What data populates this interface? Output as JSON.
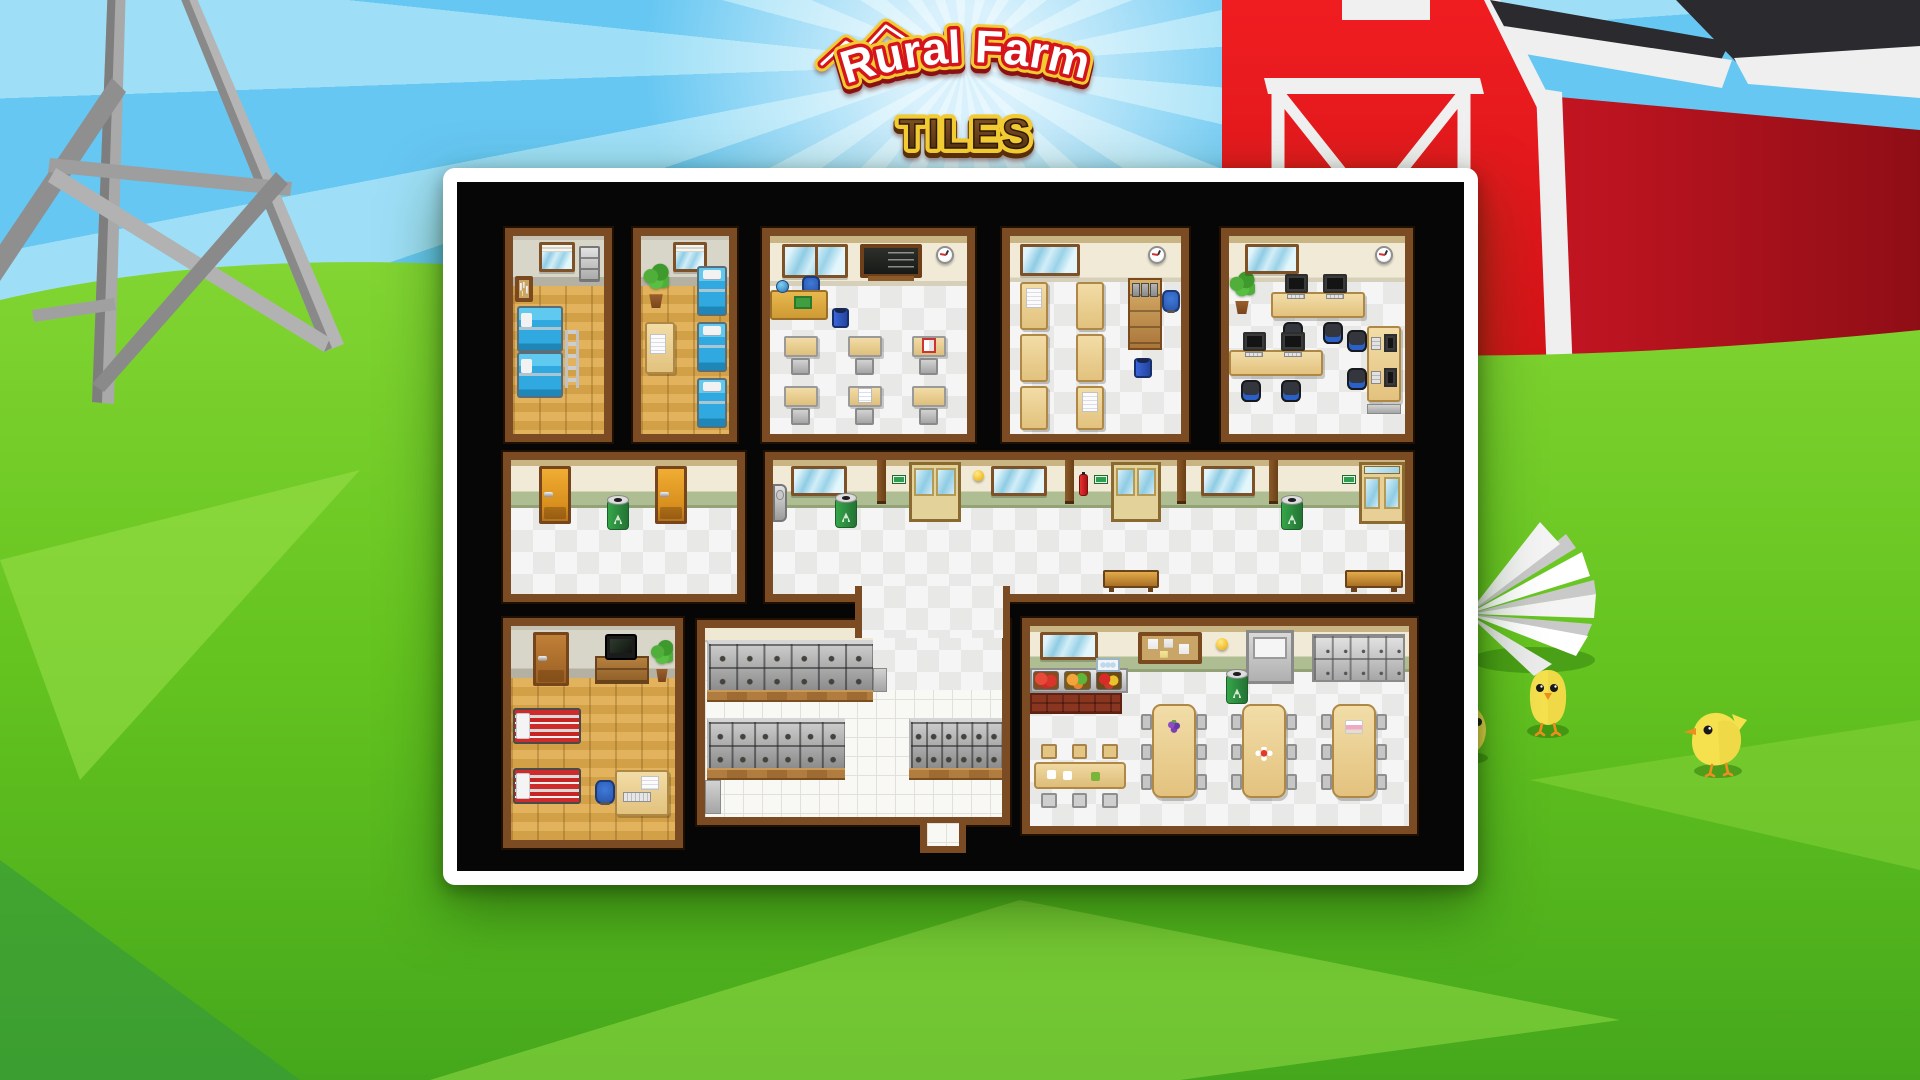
{
  "logo": {
    "line1": "Rural Farm",
    "line2": "TILES"
  },
  "scene": {
    "description": "tileset preview of a school/farmhouse interior map on a cartoon farm background",
    "decorations": [
      "water-tower",
      "red-barn",
      "sunburst-sky",
      "grass-hill",
      "white-pinwheel",
      "chicks"
    ],
    "chick_count": 3
  },
  "colors": {
    "sky_light": "#9edff7",
    "sky_ray": "#66c7f2",
    "grass": "#64c31f",
    "grass_light": "#9ae04a",
    "grass_dark": "#3fa31a",
    "barn_red": "#e81a1e",
    "barn_side": "#b01320",
    "roof_dark": "#2b2b2f",
    "trim_white": "#f0f0f0",
    "panel_bg": "#060606",
    "panel_border": "#ffffff",
    "room_frame": "#7b4b23",
    "wall_cream": "#f1ead6",
    "wainscot_green": "#aebd92",
    "wood_floor": "#d9a94e",
    "logo_red": "#d6141c",
    "logo_gold": "#f2ca32",
    "logo_brown": "#5b3317"
  },
  "panel": {
    "x": 443,
    "y": 168,
    "w": 1035,
    "h": 717,
    "border": 14
  },
  "extras": {
    "connector": {
      "x": 398,
      "y": 404,
      "w": 155,
      "h": 52
    },
    "stub": {
      "x": 463,
      "y": 641,
      "w": 46,
      "h": 30
    }
  },
  "rooms": [
    {
      "id": "dorm-a",
      "x": 48,
      "y": 46,
      "w": 107,
      "h": 214,
      "wall": "gray",
      "wallH": 50,
      "floor": "wood",
      "objects": [
        {
          "t": "window",
          "x": 26,
          "y": 6,
          "w": 36,
          "h": 30,
          "v": "blinds"
        },
        {
          "t": "cab",
          "x": 66,
          "y": 10,
          "w": 21,
          "h": 36
        },
        {
          "t": "board",
          "x": 2,
          "y": 40,
          "w": 18,
          "h": 26
        },
        {
          "t": "bunk",
          "x": 4,
          "y": 70,
          "w": 46,
          "h": 46
        },
        {
          "t": "bunk",
          "x": 4,
          "y": 116,
          "w": 46,
          "h": 46
        },
        {
          "t": "ladder",
          "x": 52,
          "y": 94,
          "w": 14,
          "h": 58
        }
      ]
    },
    {
      "id": "dorm-b",
      "x": 176,
      "y": 46,
      "w": 104,
      "h": 214,
      "wall": "gray",
      "wallH": 50,
      "floor": "wood",
      "objects": [
        {
          "t": "plant",
          "x": 2,
          "y": 26,
          "w": 26,
          "h": 46
        },
        {
          "t": "window",
          "x": 32,
          "y": 6,
          "w": 34,
          "h": 30,
          "v": "blinds"
        },
        {
          "t": "bunk",
          "x": 56,
          "y": 30,
          "w": 30,
          "h": 50,
          "v": "vert"
        },
        {
          "t": "bunk",
          "x": 56,
          "y": 86,
          "w": 30,
          "h": 50,
          "v": "vert"
        },
        {
          "t": "bunk",
          "x": 56,
          "y": 142,
          "w": 30,
          "h": 50,
          "v": "vert"
        },
        {
          "t": "deskV",
          "x": 4,
          "y": 86,
          "w": 30,
          "h": 52
        },
        {
          "t": "papers",
          "x": 9,
          "y": 98,
          "w": 16,
          "h": 20
        }
      ]
    },
    {
      "id": "classroom",
      "x": 305,
      "y": 46,
      "w": 213,
      "h": 214,
      "wall": "cream",
      "wallH": 50,
      "floor": "check",
      "objects": [
        {
          "t": "window",
          "x": 12,
          "y": 8,
          "w": 66,
          "h": 34,
          "v": "two"
        },
        {
          "t": "chalk",
          "x": 90,
          "y": 8,
          "w": 62,
          "h": 34
        },
        {
          "t": "clock",
          "x": 166,
          "y": 10,
          "w": 18,
          "h": 18
        },
        {
          "t": "ochair",
          "x": 32,
          "y": 40,
          "w": 18,
          "h": 18
        },
        {
          "t": "tdesk",
          "x": 0,
          "y": 54,
          "w": 58,
          "h": 30
        },
        {
          "t": "trash",
          "x": 62,
          "y": 72,
          "w": 17,
          "h": 20
        },
        {
          "t": "sdesk",
          "x": 14,
          "y": 100,
          "w": 34,
          "h": 40
        },
        {
          "t": "sdesk",
          "x": 78,
          "y": 100,
          "w": 34,
          "h": 40
        },
        {
          "t": "sdesk",
          "x": 142,
          "y": 100,
          "w": 34,
          "h": 40,
          "v": "book"
        },
        {
          "t": "sdesk",
          "x": 14,
          "y": 150,
          "w": 34,
          "h": 40
        },
        {
          "t": "sdesk",
          "x": 78,
          "y": 150,
          "w": 34,
          "h": 40,
          "v": "papers"
        },
        {
          "t": "sdesk",
          "x": 142,
          "y": 150,
          "w": 34,
          "h": 40
        }
      ]
    },
    {
      "id": "office",
      "x": 545,
      "y": 46,
      "w": 187,
      "h": 214,
      "wall": "cream",
      "wallH": 46,
      "floor": "check",
      "objects": [
        {
          "t": "window",
          "x": 10,
          "y": 8,
          "w": 60,
          "h": 32
        },
        {
          "t": "clock",
          "x": 138,
          "y": 10,
          "w": 18,
          "h": 18
        },
        {
          "t": "deskV",
          "x": 10,
          "y": 46,
          "w": 28,
          "h": 48
        },
        {
          "t": "papers",
          "x": 16,
          "y": 52,
          "w": 16,
          "h": 20
        },
        {
          "t": "deskV",
          "x": 66,
          "y": 46,
          "w": 28,
          "h": 48
        },
        {
          "t": "deskV",
          "x": 10,
          "y": 98,
          "w": 28,
          "h": 48
        },
        {
          "t": "deskV",
          "x": 66,
          "y": 98,
          "w": 28,
          "h": 48
        },
        {
          "t": "deskV",
          "x": 10,
          "y": 150,
          "w": 28,
          "h": 44
        },
        {
          "t": "deskV",
          "x": 66,
          "y": 150,
          "w": 28,
          "h": 44
        },
        {
          "t": "papers",
          "x": 72,
          "y": 156,
          "w": 16,
          "h": 20
        },
        {
          "t": "cabinet2",
          "x": 118,
          "y": 42,
          "w": 34,
          "h": 72
        },
        {
          "t": "ochair",
          "x": 152,
          "y": 54,
          "w": 18,
          "h": 22
        },
        {
          "t": "trash",
          "x": 124,
          "y": 122,
          "w": 18,
          "h": 20
        }
      ]
    },
    {
      "id": "computer-lab",
      "x": 764,
      "y": 46,
      "w": 192,
      "h": 214,
      "wall": "cream",
      "wallH": 46,
      "floor": "check",
      "objects": [
        {
          "t": "plant",
          "x": 0,
          "y": 34,
          "w": 26,
          "h": 44
        },
        {
          "t": "window",
          "x": 16,
          "y": 8,
          "w": 54,
          "h": 30
        },
        {
          "t": "clock",
          "x": 146,
          "y": 10,
          "w": 18,
          "h": 18
        },
        {
          "t": "pcdesk",
          "x": 42,
          "y": 56,
          "w": 94,
          "h": 26
        },
        {
          "t": "bchair",
          "x": 54,
          "y": 86,
          "w": 20,
          "h": 22
        },
        {
          "t": "bchair",
          "x": 94,
          "y": 86,
          "w": 20,
          "h": 22
        },
        {
          "t": "pcdesk",
          "x": 0,
          "y": 114,
          "w": 94,
          "h": 26
        },
        {
          "t": "bchair",
          "x": 12,
          "y": 144,
          "w": 20,
          "h": 22
        },
        {
          "t": "bchair",
          "x": 52,
          "y": 144,
          "w": 20,
          "h": 22
        },
        {
          "t": "pcdeskV",
          "x": 138,
          "y": 90,
          "w": 34,
          "h": 76
        },
        {
          "t": "bchair",
          "x": 118,
          "y": 94,
          "w": 20,
          "h": 22
        },
        {
          "t": "bchair",
          "x": 118,
          "y": 132,
          "w": 20,
          "h": 22
        },
        {
          "t": "mat",
          "x": 138,
          "y": 168,
          "w": 34,
          "h": 10
        }
      ]
    },
    {
      "id": "hall-west",
      "x": 46,
      "y": 270,
      "w": 242,
      "h": 150,
      "wall": "hall",
      "wallH": 48,
      "floor": "check",
      "objects": [
        {
          "t": "door",
          "x": 28,
          "y": 6,
          "w": 32,
          "h": 58
        },
        {
          "t": "door",
          "x": 144,
          "y": 6,
          "w": 32,
          "h": 58
        },
        {
          "t": "recycle",
          "x": 96,
          "y": 40,
          "w": 22,
          "h": 30
        }
      ]
    },
    {
      "id": "hall-main",
      "x": 308,
      "y": 270,
      "w": 648,
      "h": 150,
      "wall": "hall",
      "wallH": 48,
      "floor": "check",
      "objects": [
        {
          "t": "fountain",
          "x": 0,
          "y": 24,
          "w": 14,
          "h": 38
        },
        {
          "t": "window",
          "x": 18,
          "y": 6,
          "w": 56,
          "h": 30
        },
        {
          "t": "recycle",
          "x": 62,
          "y": 38,
          "w": 22,
          "h": 30
        },
        {
          "t": "pilaster",
          "x": 104,
          "y": 0,
          "w": 9,
          "h": 44
        },
        {
          "t": "sign",
          "x": 120,
          "y": 16,
          "w": 12,
          "h": 7
        },
        {
          "t": "ddoor",
          "x": 136,
          "y": 2,
          "w": 52,
          "h": 60
        },
        {
          "t": "ball",
          "x": 200,
          "y": 10,
          "w": 11,
          "h": 11
        },
        {
          "t": "window",
          "x": 218,
          "y": 6,
          "w": 56,
          "h": 30
        },
        {
          "t": "pilaster",
          "x": 292,
          "y": 0,
          "w": 9,
          "h": 44
        },
        {
          "t": "ext",
          "x": 306,
          "y": 14,
          "w": 9,
          "h": 22
        },
        {
          "t": "sign",
          "x": 322,
          "y": 16,
          "w": 12,
          "h": 7
        },
        {
          "t": "ddoor",
          "x": 338,
          "y": 2,
          "w": 50,
          "h": 60
        },
        {
          "t": "pilaster",
          "x": 404,
          "y": 0,
          "w": 9,
          "h": 44
        },
        {
          "t": "window",
          "x": 428,
          "y": 6,
          "w": 54,
          "h": 30
        },
        {
          "t": "pilaster",
          "x": 496,
          "y": 0,
          "w": 9,
          "h": 44
        },
        {
          "t": "recycle",
          "x": 508,
          "y": 40,
          "w": 22,
          "h": 30
        },
        {
          "t": "sign",
          "x": 570,
          "y": 16,
          "w": 12,
          "h": 7
        },
        {
          "t": "gdoor",
          "x": 586,
          "y": 2,
          "w": 46,
          "h": 62
        },
        {
          "t": "bench",
          "x": 330,
          "y": 110,
          "w": 56,
          "h": 18
        },
        {
          "t": "bench",
          "x": 572,
          "y": 110,
          "w": 58,
          "h": 18
        }
      ]
    },
    {
      "id": "dorm-c",
      "x": 46,
      "y": 436,
      "w": 180,
      "h": 230,
      "wall": "gray",
      "wallH": 52,
      "floor": "wood",
      "objects": [
        {
          "t": "door",
          "x": 22,
          "y": 6,
          "w": 36,
          "h": 54,
          "v": "brown"
        },
        {
          "t": "dresser",
          "x": 84,
          "y": 30,
          "w": 54,
          "h": 28
        },
        {
          "t": "tv",
          "x": 94,
          "y": 8,
          "w": 32,
          "h": 26
        },
        {
          "t": "plant",
          "x": 140,
          "y": 12,
          "w": 22,
          "h": 44
        },
        {
          "t": "redbed",
          "x": 2,
          "y": 82,
          "w": 68,
          "h": 36
        },
        {
          "t": "redbed",
          "x": 2,
          "y": 142,
          "w": 68,
          "h": 36
        },
        {
          "t": "deskV",
          "x": 104,
          "y": 144,
          "w": 54,
          "h": 46
        },
        {
          "t": "papers",
          "x": 130,
          "y": 150,
          "w": 18,
          "h": 14
        },
        {
          "t": "kb",
          "x": 112,
          "y": 166,
          "w": 28,
          "h": 10
        },
        {
          "t": "ochair",
          "x": 84,
          "y": 154,
          "w": 20,
          "h": 24
        }
      ]
    },
    {
      "id": "shoe-lockers",
      "x": 240,
      "y": 438,
      "w": 313,
      "h": 205,
      "wall": "creamthin",
      "wallH": 14,
      "floor": "tile",
      "objects": [
        {
          "t": "checkpatch",
          "x": 168,
          "y": 0,
          "w": 129,
          "h": 62
        },
        {
          "t": "cubby",
          "x": 2,
          "y": 12,
          "w": 166,
          "h": 50
        },
        {
          "t": "woodstrip",
          "x": 2,
          "y": 62,
          "w": 166,
          "h": 12
        },
        {
          "t": "step",
          "x": 168,
          "y": 40,
          "w": 14,
          "h": 24
        },
        {
          "t": "cubby",
          "x": 2,
          "y": 90,
          "w": 138,
          "h": 50
        },
        {
          "t": "woodstrip",
          "x": 2,
          "y": 140,
          "w": 138,
          "h": 12
        },
        {
          "t": "cubby",
          "x": 204,
          "y": 90,
          "w": 93,
          "h": 50
        },
        {
          "t": "woodstrip",
          "x": 204,
          "y": 140,
          "w": 93,
          "h": 12
        },
        {
          "t": "step",
          "x": 0,
          "y": 152,
          "w": 16,
          "h": 34
        }
      ]
    },
    {
      "id": "cafeteria",
      "x": 565,
      "y": 436,
      "w": 395,
      "h": 216,
      "wall": "hall",
      "wallH": 46,
      "floor": "check",
      "objects": [
        {
          "t": "window",
          "x": 10,
          "y": 6,
          "w": 58,
          "h": 28
        },
        {
          "t": "board",
          "x": 108,
          "y": 6,
          "w": 64,
          "h": 32,
          "v": "cork"
        },
        {
          "t": "ball",
          "x": 186,
          "y": 12,
          "w": 12,
          "h": 12
        },
        {
          "t": "mdoor",
          "x": 216,
          "y": 4,
          "w": 48,
          "h": 54
        },
        {
          "t": "lockers",
          "x": 282,
          "y": 8,
          "w": 93,
          "h": 48
        },
        {
          "t": "recycle",
          "x": 196,
          "y": 48,
          "w": 22,
          "h": 30
        },
        {
          "t": "counter",
          "x": 0,
          "y": 42,
          "w": 98,
          "h": 48
        },
        {
          "t": "crate",
          "x": 66,
          "y": 32,
          "w": 24,
          "h": 14
        },
        {
          "t": "smtable",
          "x": 4,
          "y": 118,
          "w": 92,
          "h": 64
        },
        {
          "t": "tableL",
          "x": 122,
          "y": 78,
          "w": 44,
          "h": 94,
          "v": "grape"
        },
        {
          "t": "tableL",
          "x": 212,
          "y": 78,
          "w": 44,
          "h": 94,
          "v": "flower"
        },
        {
          "t": "tableL",
          "x": 302,
          "y": 78,
          "w": 44,
          "h": 94,
          "v": "cake"
        }
      ]
    }
  ]
}
